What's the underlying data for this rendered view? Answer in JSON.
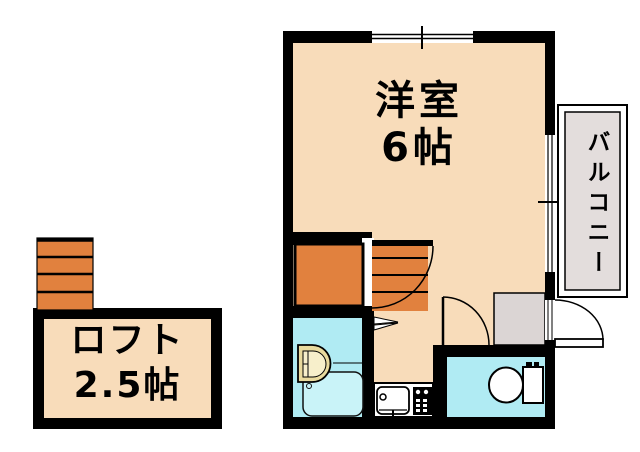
{
  "rooms": {
    "main_room": {
      "name": "洋室",
      "size": "6帖"
    },
    "loft": {
      "name": "ロフト",
      "size": "2.5帖"
    },
    "balcony": {
      "name": "バルコニー"
    }
  },
  "colors": {
    "wall": "#000000",
    "room_fill": "#F8DCBA",
    "stairs_fill": "#E1813E",
    "wet_area_fill": "#B0EBF3",
    "bathtub_fill": "#C9F3F8",
    "balcony_fill": "#E3DDDC",
    "entrance_fill": "#DBD5D4",
    "washbasin_fill": "#E9DA9E",
    "washbasin_inner_fill": "#F7EFCB",
    "fixture_fill": "#FFFFFF"
  }
}
